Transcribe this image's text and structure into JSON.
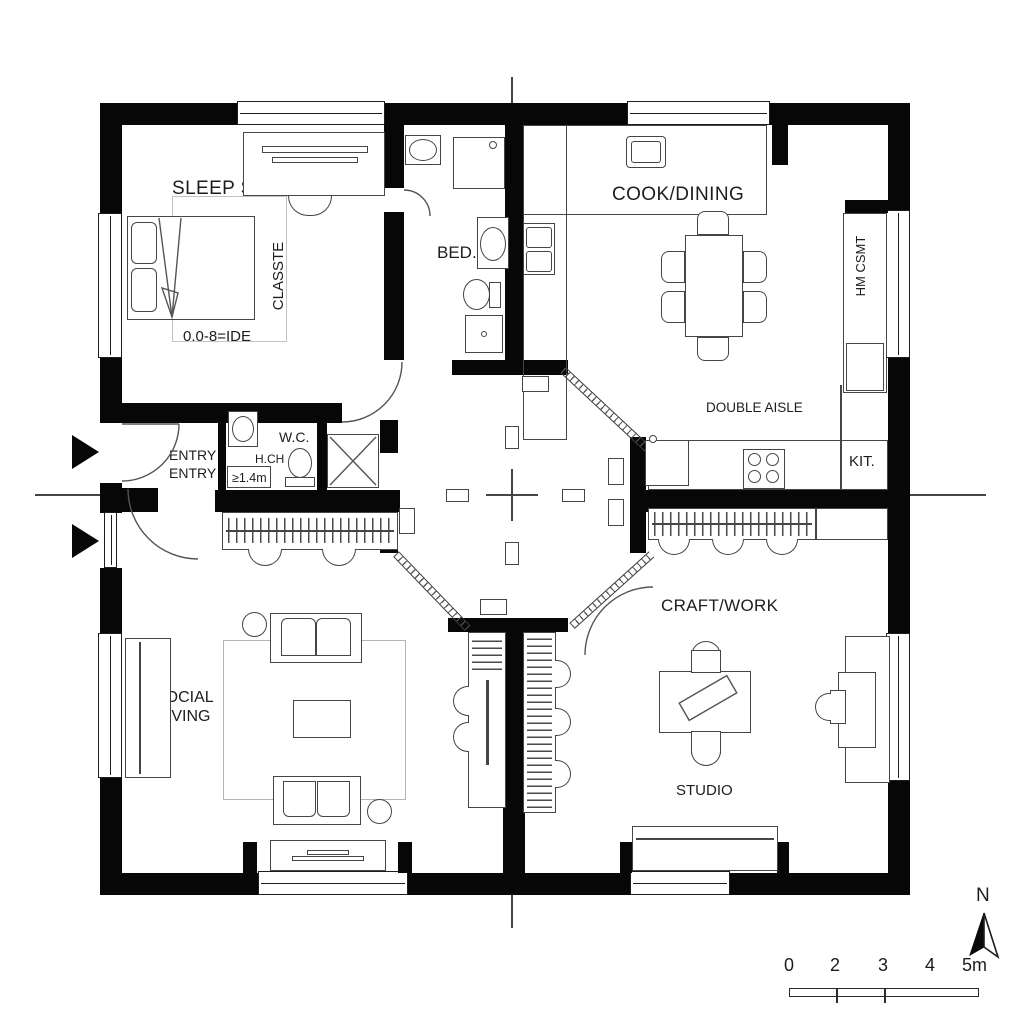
{
  "labels": {
    "sleep_suite": "SLEEP SUITE",
    "closet": "CLASSTE",
    "bed_dim": "0.0-8=IDE",
    "bed": "BED.",
    "cook_dining": "COOK/DINING",
    "double_aisle": "DOUBLE AISLE",
    "cabinet": "HM CSMT",
    "kit": "KIT.",
    "entry1": "ENTRY",
    "entry2": "ENTRY",
    "wc": "W.C.",
    "hch": "H.CH",
    "min_clearance": "≥1.4m",
    "social1": "SOCIAL",
    "social2": "LIVING",
    "craft_work": "CRAFT/WORK",
    "studio": "STUDIO"
  },
  "scale_bar": {
    "t0": "0",
    "t1": "2",
    "t2": "3",
    "t3": "4",
    "t4": "5m"
  },
  "compass": {
    "north": "N"
  },
  "colors": {
    "wall": "#070707",
    "line": "#454545",
    "text": "#1d1d1d"
  }
}
